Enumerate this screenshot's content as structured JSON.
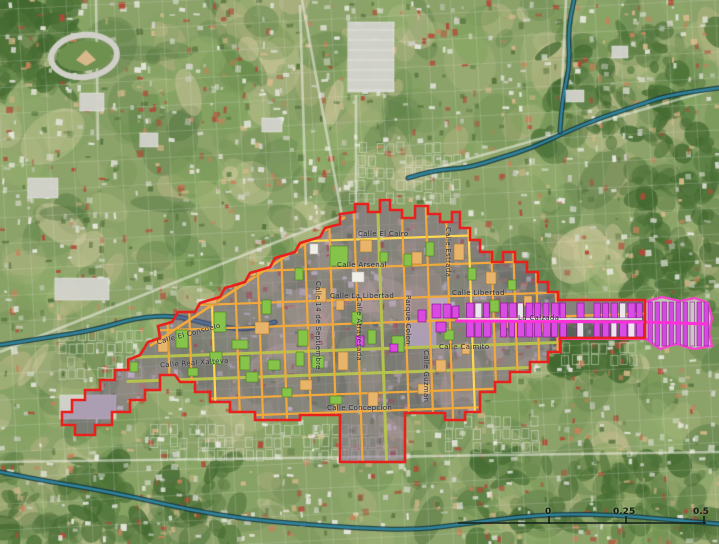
{
  "map": {
    "street_labels": {
      "el_cairo": "Calle El Cairo",
      "arsenal": "Calle Arsenal",
      "la_libertad": "Calle La Libertad",
      "libertad_east": "Calle Libertad",
      "real_xalteva": "Calle Real Xalteva",
      "el_consuelo": "Calle El Consuelo",
      "concepcion": "Calle Concepcion",
      "caimito": "Calle Caimito",
      "la_calzada": "La Calzada",
      "atravesada": "Calle Atravesada",
      "guzman": "Calle Guzman",
      "estrada": "Calle Estrada",
      "parque_colon": "Parque Colon",
      "septiembre": "Calle 14 de Septiembre"
    },
    "scale_bar": {
      "tick_start": "0",
      "tick_mid": "0.25",
      "tick_end": "0.5"
    },
    "colors": {
      "boundary_red": "#e8211c",
      "corridor_pink": "#ff3fd4",
      "parcel_magenta": "#da4ae0",
      "parcel_green": "#86c34a",
      "parcel_tan": "#e7b469",
      "street_orange": "#f2a93b",
      "street_yellow": "#ffd84f",
      "river_teal": "#2f8ba6"
    }
  }
}
